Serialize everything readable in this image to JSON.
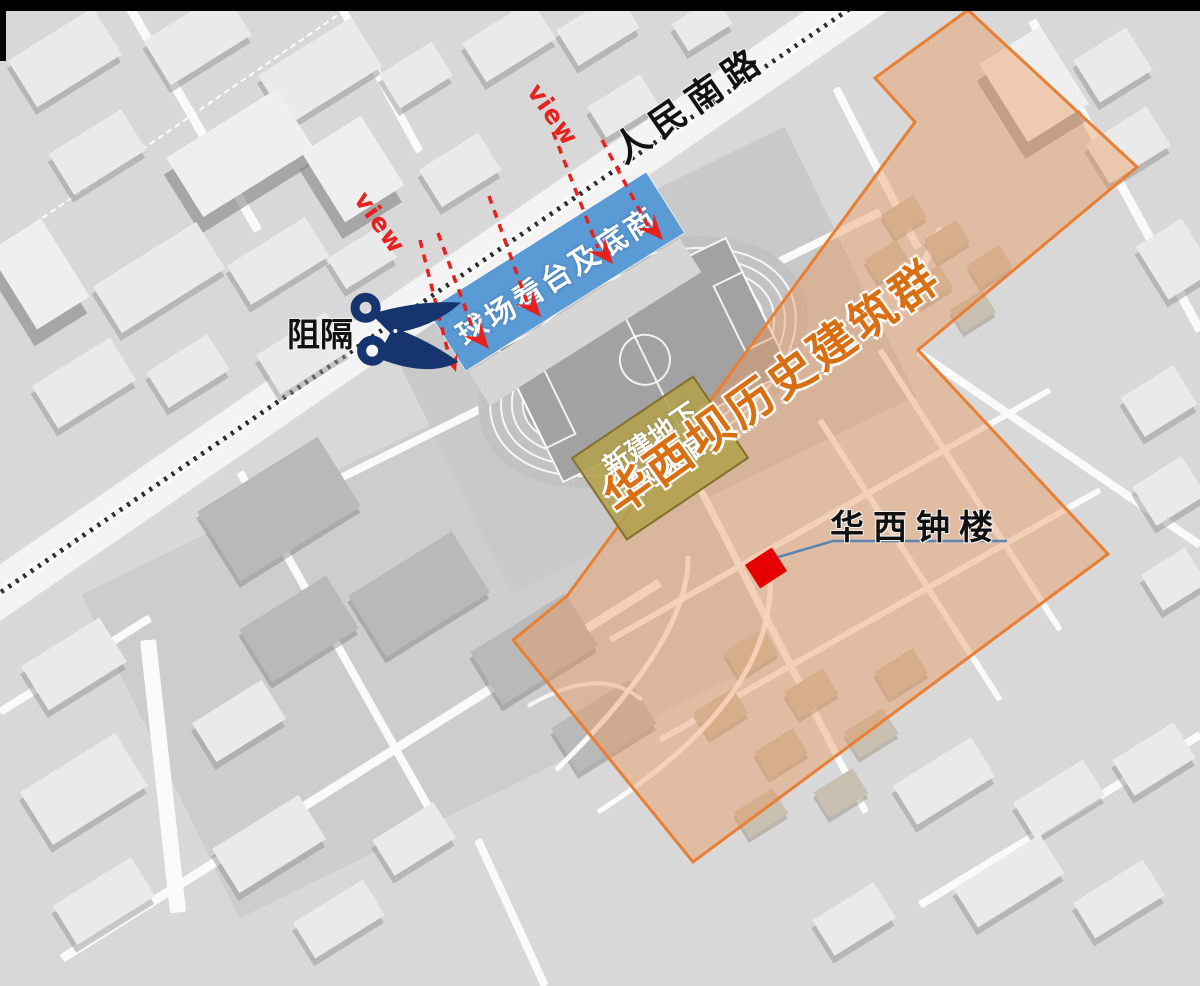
{
  "map": {
    "road_label": "人民南路",
    "barrier_label": "阻隔",
    "view_label": "view",
    "stand_label": "球场看台及底商",
    "tennis_hall_label": "新建地下\n网球馆",
    "historic_area_label": "华西坝历史建筑群",
    "clock_tower_label": "华西钟楼"
  },
  "colors": {
    "stand_blue": "#5b9bd5",
    "tennis_khaki": "#b3a04c",
    "historic_orange_border": "#e87f35",
    "historic_orange_fill": "rgba(235,150,88,0.42)",
    "historic_orange_text": "#d96f10",
    "arrow_red": "#e8211c",
    "scissors_navy": "#16346d",
    "leader_blue": "#5b84b1",
    "clock_marker_red": "#e60000"
  }
}
